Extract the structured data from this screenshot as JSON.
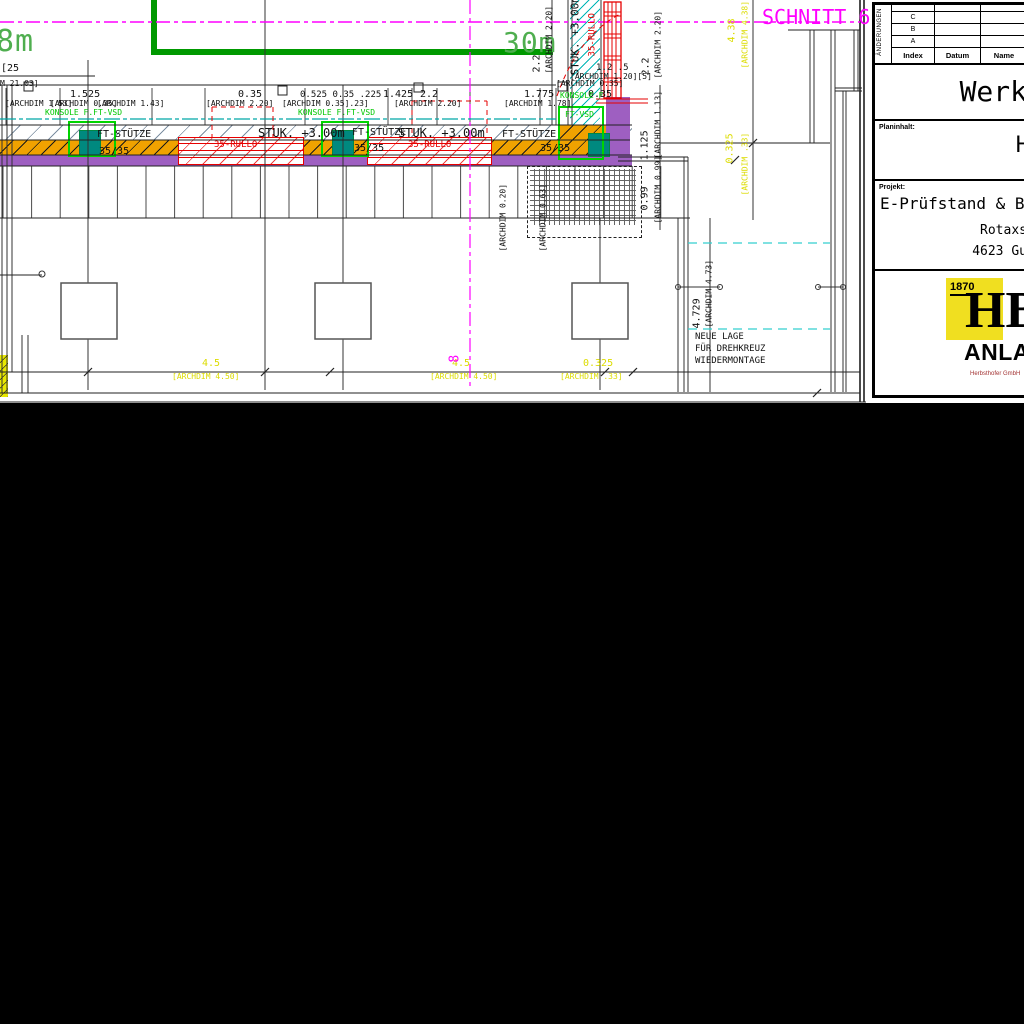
{
  "drawing": {
    "green_labels": {
      "left": "8m",
      "right": "30m"
    },
    "section_label": "SCHNITT 6",
    "grid_bubble": "8",
    "note": {
      "lines": [
        "NEUE LAGE",
        "FÜR DREHKREUZ",
        "WIEDERMONTAGE"
      ]
    },
    "colors": {
      "beam_fill": "#F0A200",
      "wall_fill": "#9E5FC1",
      "column_fill": "#00897F",
      "konsole_green": "#00C800",
      "axis_magenta": "#FF00FF",
      "dim_yellow": "#DCDC00",
      "rullo_red": "#E60000",
      "insulation_cyan": "#00B6B6"
    },
    "annotations": [
      {
        "t": "[25",
        "x": 1,
        "y": 64,
        "s": 10,
        "c": "k"
      },
      {
        "t": "M 21.03]",
        "x": 0,
        "y": 80,
        "s": 8,
        "c": "k"
      },
      {
        "t": "1.525",
        "x": 70,
        "y": 90,
        "s": 10,
        "c": "k"
      },
      {
        "t": "0.35",
        "x": 238,
        "y": 90,
        "s": 10,
        "c": "k"
      },
      {
        "t": "0.525 0.35 .225",
        "x": 300,
        "y": 91,
        "s": 9,
        "c": "k"
      },
      {
        "t": "1.425",
        "x": 383,
        "y": 90,
        "s": 10,
        "c": "k"
      },
      {
        "t": "2.2",
        "x": 420,
        "y": 90,
        "s": 10,
        "c": "k"
      },
      {
        "t": "1.775",
        "x": 524,
        "y": 90,
        "s": 10,
        "c": "k"
      },
      {
        "t": "0.35",
        "x": 588,
        "y": 90,
        "s": 10,
        "c": "k"
      },
      {
        "t": "[ARCHDIM 1.53]",
        "x": 5,
        "y": 100,
        "s": 8,
        "c": "k"
      },
      {
        "t": "[ARCHDIM 0.35]",
        "x": 50,
        "y": 100,
        "s": 8,
        "c": "k"
      },
      {
        "t": "[ARCHDIM 1.43]",
        "x": 97,
        "y": 100,
        "s": 8,
        "c": "k"
      },
      {
        "t": "[ARCHDIM 2.20]",
        "x": 206,
        "y": 100,
        "s": 8,
        "c": "k"
      },
      {
        "t": "[ARCHDIM 0.35].23]",
        "x": 282,
        "y": 100,
        "s": 8,
        "c": "k"
      },
      {
        "t": "[ARCHDIM 2.20]",
        "x": 394,
        "y": 100,
        "s": 8,
        "c": "k"
      },
      {
        "t": "[ARCHDIM 1.78]",
        "x": 504,
        "y": 100,
        "s": 8,
        "c": "k"
      },
      {
        "t": "[ARCHDIM 0.35]",
        "x": 556,
        "y": 80,
        "s": 8,
        "c": "k"
      },
      {
        "t": "[ARCHDIM 1.20][5]",
        "x": 570,
        "y": 73,
        "s": 8,
        "c": "k"
      },
      {
        "t": "1.2 .5",
        "x": 596,
        "y": 64,
        "s": 9,
        "c": "k"
      },
      {
        "t": "FT-STÜTZE",
        "x": 97,
        "y": 130,
        "s": 10,
        "c": "k"
      },
      {
        "t": "35/35",
        "x": 99,
        "y": 147,
        "s": 10,
        "c": "k"
      },
      {
        "t": "FT-STÜTZE",
        "x": 352,
        "y": 128,
        "s": 10,
        "c": "k"
      },
      {
        "t": "35/35",
        "x": 354,
        "y": 144,
        "s": 10,
        "c": "k"
      },
      {
        "t": "FT-STÜTZE",
        "x": 502,
        "y": 130,
        "s": 10,
        "c": "k"
      },
      {
        "t": "35/35",
        "x": 540,
        "y": 144,
        "s": 10,
        "c": "k"
      },
      {
        "t": "STUK. +3.00m",
        "x": 258,
        "y": 127,
        "s": 12,
        "c": "k"
      },
      {
        "t": "STUK. +3.00m",
        "x": 398,
        "y": 127,
        "s": 12,
        "c": "k"
      },
      {
        "t": "35-RULLO",
        "x": 214,
        "y": 141,
        "s": 9,
        "c": "r"
      },
      {
        "t": "35-RULLO",
        "x": 408,
        "y": 141,
        "s": 9,
        "c": "r"
      },
      {
        "t": "KONSOLE F.FT-VSD",
        "x": 45,
        "y": 109,
        "s": 8,
        "c": "g"
      },
      {
        "t": "KONSOLE F.FT-VSD",
        "x": 298,
        "y": 109,
        "s": 8,
        "c": "g"
      },
      {
        "t": "KONSOLE F",
        "x": 560,
        "y": 92,
        "s": 8,
        "c": "g"
      },
      {
        "t": "FT-VSD",
        "x": 565,
        "y": 111,
        "s": 8,
        "c": "g"
      },
      {
        "t": "4.5",
        "x": 202,
        "y": 359,
        "s": 10,
        "c": "y"
      },
      {
        "t": "[ARCHDIM 4.50]",
        "x": 172,
        "y": 373,
        "s": 8,
        "c": "y"
      },
      {
        "t": "4.5",
        "x": 452,
        "y": 359,
        "s": 10,
        "c": "y"
      },
      {
        "t": "[ARCHDIM 4.50]",
        "x": 430,
        "y": 373,
        "s": 8,
        "c": "y"
      },
      {
        "t": "0.325",
        "x": 583,
        "y": 359,
        "s": 10,
        "c": "y"
      },
      {
        "t": "[ARCHDIM .33]",
        "x": 560,
        "y": 373,
        "s": 8,
        "c": "y"
      },
      {
        "t": "2.2",
        "x": 543,
        "y": 62,
        "s": 10,
        "c": "k",
        "r": 1
      },
      {
        "t": "[ARCHDIM 2.20]",
        "x": 554,
        "y": 65,
        "s": 8,
        "c": "k",
        "r": 1
      },
      {
        "t": "STUK. +3.00m",
        "x": 581,
        "y": 64,
        "s": 11,
        "c": "k",
        "r": 1
      },
      {
        "t": "35-RULLO",
        "x": 598,
        "y": 47,
        "s": 9,
        "c": "r",
        "r": 1
      },
      {
        "t": "2.2",
        "x": 652,
        "y": 65,
        "s": 10,
        "c": "k",
        "r": 1
      },
      {
        "t": "[ARCHDIM 2.20]",
        "x": 663,
        "y": 70,
        "s": 8,
        "c": "k",
        "r": 1
      },
      {
        "t": "1.125",
        "x": 651,
        "y": 150,
        "s": 10,
        "c": "k",
        "r": 1
      },
      {
        "t": "[ARCHDIM 1.13]",
        "x": 663,
        "y": 150,
        "s": 8,
        "c": "k",
        "r": 1
      },
      {
        "t": "0.99",
        "x": 651,
        "y": 200,
        "s": 10,
        "c": "k",
        "r": 1
      },
      {
        "t": "[ARCHDIM 0.99]",
        "x": 663,
        "y": 215,
        "s": 8,
        "c": "k",
        "r": 1
      },
      {
        "t": "4.729",
        "x": 703,
        "y": 318,
        "s": 10,
        "c": "k",
        "r": 1
      },
      {
        "t": "[ARCHDIM 4.73]",
        "x": 714,
        "y": 319,
        "s": 8,
        "c": "k",
        "r": 1
      },
      {
        "t": "[ARCHDIM 0.20]",
        "x": 508,
        "y": 243,
        "s": 8,
        "c": "k",
        "r": 1
      },
      {
        "t": "[ARCHDIM 0.63]",
        "x": 548,
        "y": 243,
        "s": 8,
        "c": "k",
        "r": 1
      },
      {
        "t": "4.38",
        "x": 738,
        "y": 32,
        "s": 10,
        "c": "y",
        "r": 1
      },
      {
        "t": "[ARCHDIM 4.38]",
        "x": 750,
        "y": 60,
        "s": 8,
        "c": "y",
        "r": 1
      },
      {
        "t": "0.325",
        "x": 736,
        "y": 153,
        "s": 10,
        "c": "y",
        "r": 1
      },
      {
        "t": "[ARCHDIM .33]",
        "x": 750,
        "y": 187,
        "s": 8,
        "c": "y",
        "r": 1
      },
      {
        "t": "8",
        "x": 462,
        "y": 349,
        "s": 13,
        "c": "m",
        "r": 1
      }
    ]
  },
  "title_block": {
    "revision_table": {
      "side_label": "ÄNDERUNGEN",
      "rows": [
        "",
        "C",
        "B",
        "A"
      ],
      "headers": [
        "Index",
        "Datum",
        "Name"
      ]
    },
    "title": "Werk",
    "planinhalt_label": "Planinhalt:",
    "planinhalt_value": "H",
    "projekt_label": "Projekt:",
    "projekt_name": "E-Prüfstand & B",
    "projekt_street": "Rotaxs",
    "projekt_city": "4623 Gu",
    "logo": {
      "year": "1870",
      "monogram": "HB",
      "brand": "ANLA",
      "subtext": "Herbsthofer GmbH"
    }
  }
}
